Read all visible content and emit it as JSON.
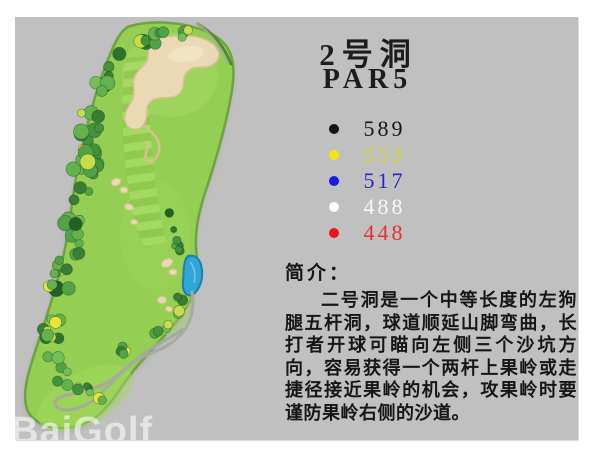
{
  "slide": {
    "background": "#c0c0c0"
  },
  "hole": {
    "number_label": "2号洞",
    "par_label": "PAR5"
  },
  "tees": [
    {
      "name": "black-tee",
      "dot_color": "#141414",
      "text_color": "#161616",
      "distance": "589"
    },
    {
      "name": "yellow-tee",
      "dot_color": "#f4e70c",
      "text_color": "#d8d23c",
      "distance": "553"
    },
    {
      "name": "blue-tee",
      "dot_color": "#1b1bdf",
      "text_color": "#2626cf",
      "distance": "517"
    },
    {
      "name": "white-tee",
      "dot_color": "#fdfdfd",
      "text_color": "#f8f8f8",
      "distance": "488"
    },
    {
      "name": "red-tee",
      "dot_color": "#ec1515",
      "text_color": "#e63030",
      "distance": "448"
    }
  ],
  "intro": {
    "heading": "简介：",
    "body": "二号洞是一个中等长度的左狗腿五杆洞，球道顺延山脚弯曲，长打者开球可瞄向左侧三个沙坑方向，容易获得一个两杆上果岭或走捷径接近果岭的机会，攻果岭时要谨防果岭右侧的沙道。"
  },
  "watermark": "BaiGolf",
  "map": {
    "colors": {
      "fairway_green": "#94ce52",
      "outline_green": "#6da342",
      "stripe_light": "#a7db63",
      "stripe_dark": "#8ec94d",
      "sand": "#ead9b4",
      "sand_edge": "#d7c193",
      "water": "#31a5d8",
      "water_edge": "#1d7fab",
      "cart_path": "#a2ac9e"
    }
  }
}
